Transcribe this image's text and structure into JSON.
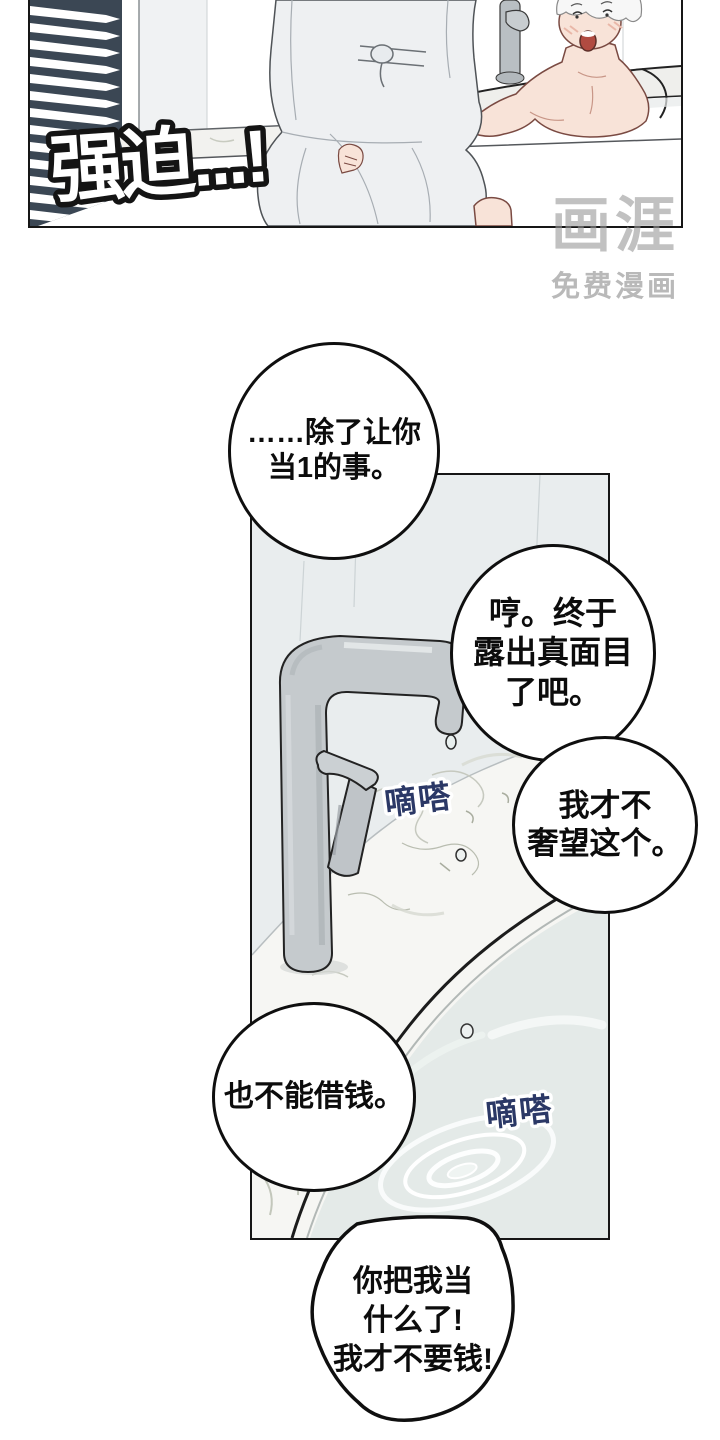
{
  "panel1": {
    "sfx": "强迫...!"
  },
  "watermark": {
    "logo": "画涯",
    "tagline": "免费漫画"
  },
  "speech_bubbles": {
    "b1": "……除了让你\n当1的事。",
    "b2": "哼。终于\n露出真面目\n了吧。",
    "b3": "我才不\n奢望这个。",
    "b4": "也不能借钱。",
    "b5": "你把我当\n什么了!\n我才不要钱!"
  },
  "sfx": {
    "drip1": "嘀嗒",
    "drip2": "嘀嗒"
  },
  "colors": {
    "ink": "#161616",
    "blinds": "#3b4754",
    "faucet_gray": "#c5cacd",
    "wall_gray": "#e9edee",
    "marble": "#f6f6f3",
    "water": "#e4eae8",
    "skin": "#f8e3d8",
    "robe": "#eef0f2",
    "drip_text": "#2b3866",
    "mouth_red": "#b14b41",
    "watermark_gray": "#989898"
  }
}
